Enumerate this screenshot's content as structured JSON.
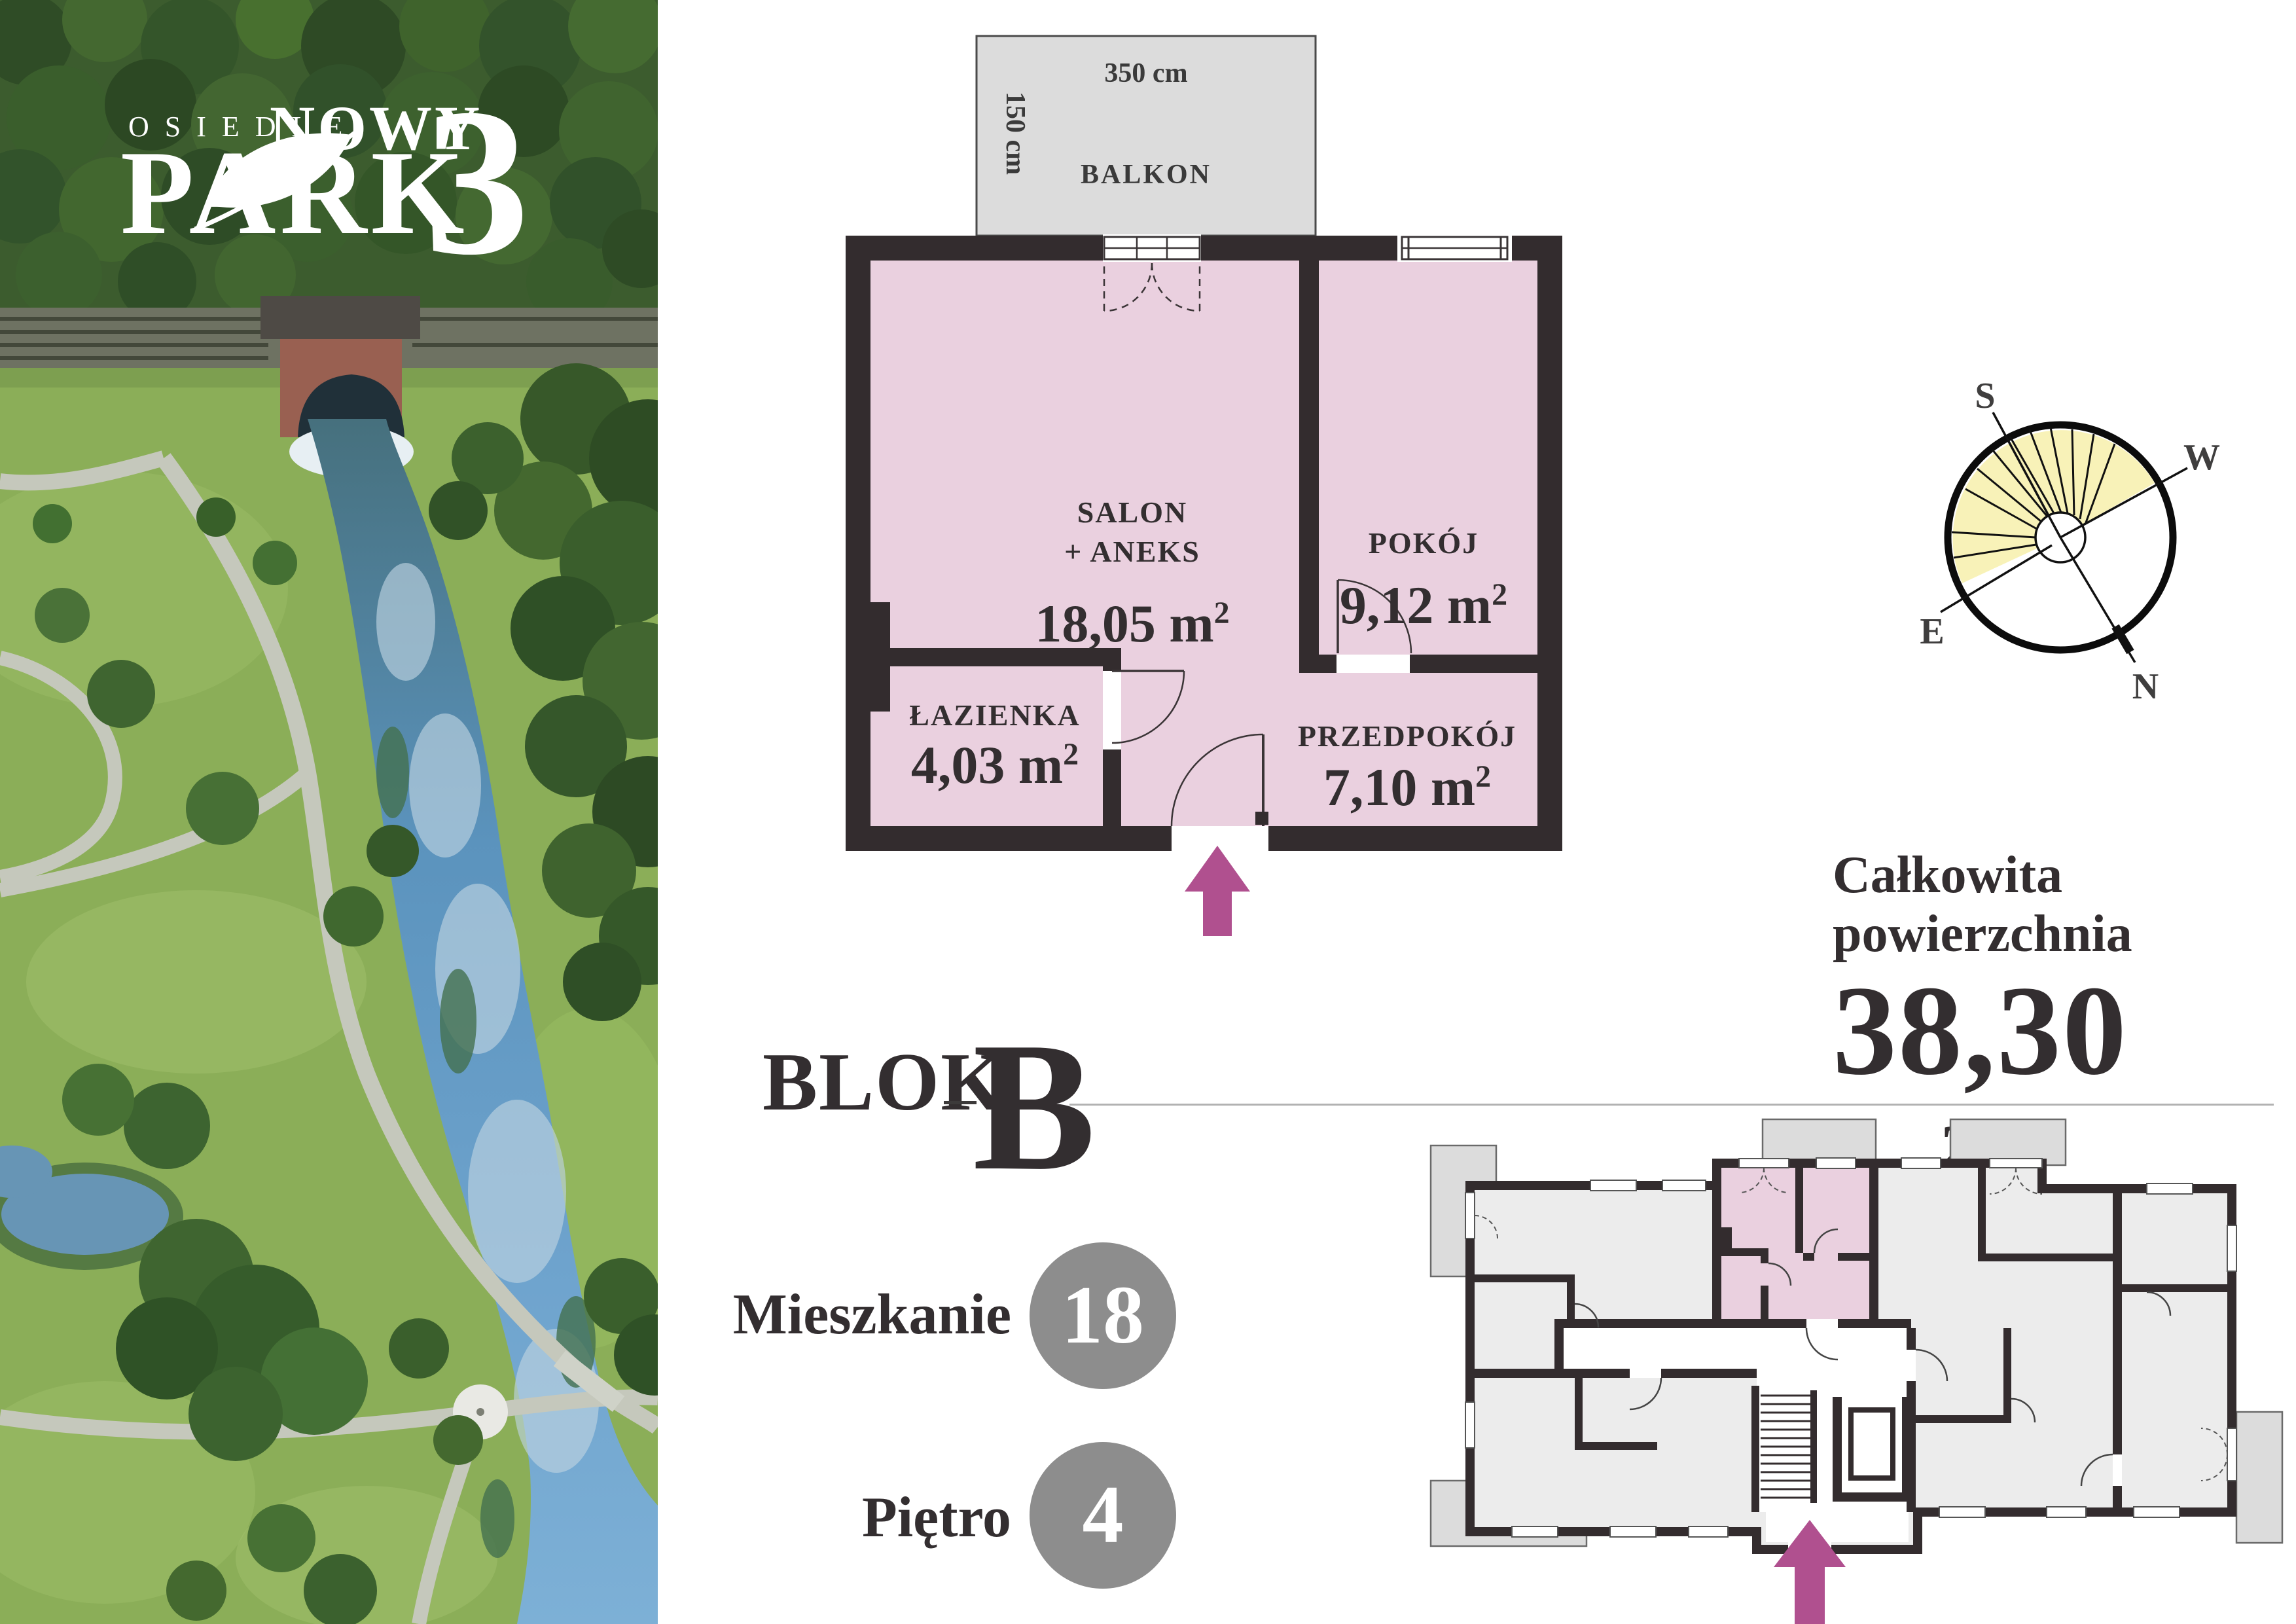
{
  "logo": {
    "osiedle": "OSIEDLE",
    "nowy": "NOWY",
    "park": "PARK",
    "number": "3"
  },
  "plan": {
    "balkon": {
      "name": "BALKON",
      "width": "350 cm",
      "depth": "150 cm"
    },
    "salon": {
      "name": "SALON",
      "name2": "+ ANEKS",
      "area": "18,05 m"
    },
    "pokoj": {
      "name": "POKÓJ",
      "area": "9,12 m"
    },
    "lazienka": {
      "name": "ŁAZIENKA",
      "area": "4,03 m"
    },
    "przedpokoj": {
      "name": "PRZEDPOKÓJ",
      "area": "7,10 m"
    },
    "sup": "2"
  },
  "compass": {
    "s": "S",
    "w": "W",
    "e": "E",
    "n": "N"
  },
  "summary": {
    "line1": "Całkowita",
    "line2": "powierzchnia",
    "area": "38,30 m",
    "sup": "2"
  },
  "block": {
    "label": "BLOK",
    "value": "B"
  },
  "unit": {
    "label": "Mieszkanie",
    "value": "18"
  },
  "floor": {
    "label": "Piętro",
    "value": "4"
  },
  "colors": {
    "wall": "#332c2e",
    "room_pink": "#ead0df",
    "balcony_gray": "#dcdcdc",
    "accent_arrow": "#b0508f",
    "sun_yellow": "#f8f2b8",
    "badge_gray": "#8d8d8d",
    "building_room": "#ececec"
  }
}
